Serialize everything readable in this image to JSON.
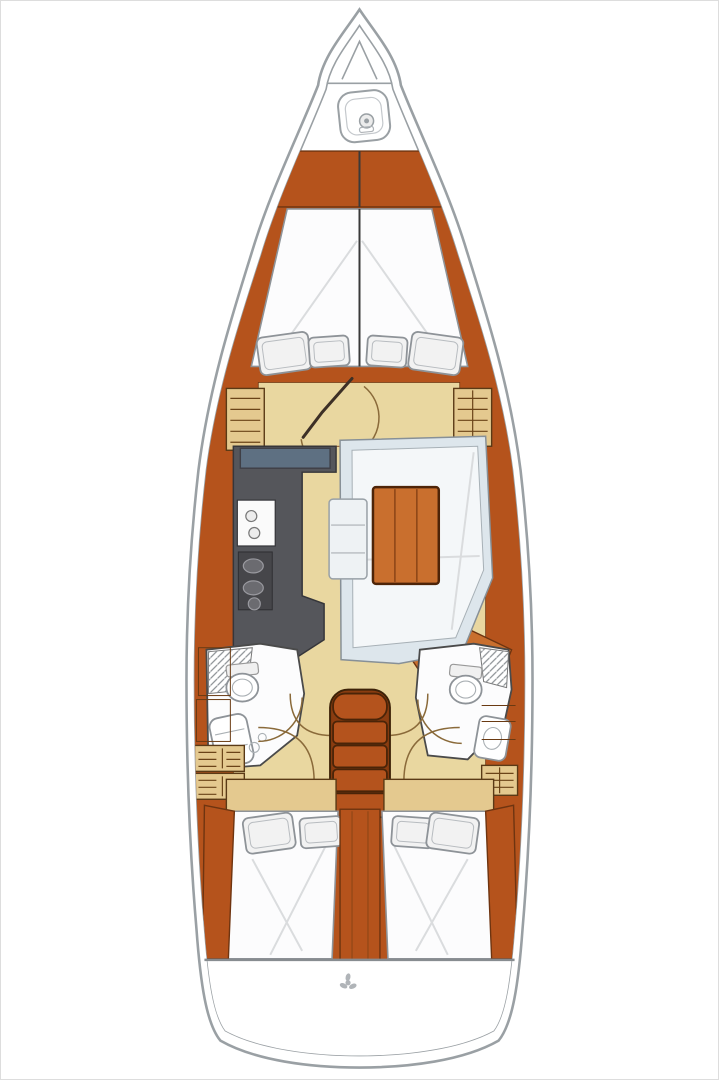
{
  "page": {
    "background": "#ffffff",
    "frame_border": "#dddddd"
  },
  "diagram": {
    "type": "sailboat-interior-deck-plan",
    "orientation": "bow-up",
    "features": [
      "anchor-locker-with-windlass",
      "foredeck",
      "forward-cabin-v-berth",
      "forward-cabin-pillows",
      "forward-cabin-lockers",
      "forward-cabin-door",
      "mast-post",
      "galley-counter",
      "galley-sink",
      "galley-stove",
      "salon-settee",
      "salon-table",
      "salon-bench",
      "head-port-with-toilet-and-vanity",
      "head-starboard-with-toilet-and-sink",
      "companionway-steps",
      "aft-cabin-port-berth",
      "aft-cabin-starboard-berth",
      "engine-compartment",
      "transom",
      "propeller"
    ]
  },
  "colors": {
    "hull_line": "#9aa0a4",
    "wood": "#b5531c",
    "wood_light": "#c96f2e",
    "wood_dark": "#6e3410",
    "floor": "#e9d7a0",
    "locker": "#e4c98f",
    "counter": "#55565b",
    "counter_blue": "#5e7082",
    "berth": "#fcfcfd",
    "cushion": "#dde6ec",
    "cushion_light": "#f4f7f9",
    "pillow": "#f2f2f2",
    "pillow_line": "#8e9398",
    "steps": "#b4531d",
    "steps_dark": "#4a2408",
    "stove": "#46464a",
    "arc": "#8a6a3a",
    "metal": "#b0b4b8"
  }
}
